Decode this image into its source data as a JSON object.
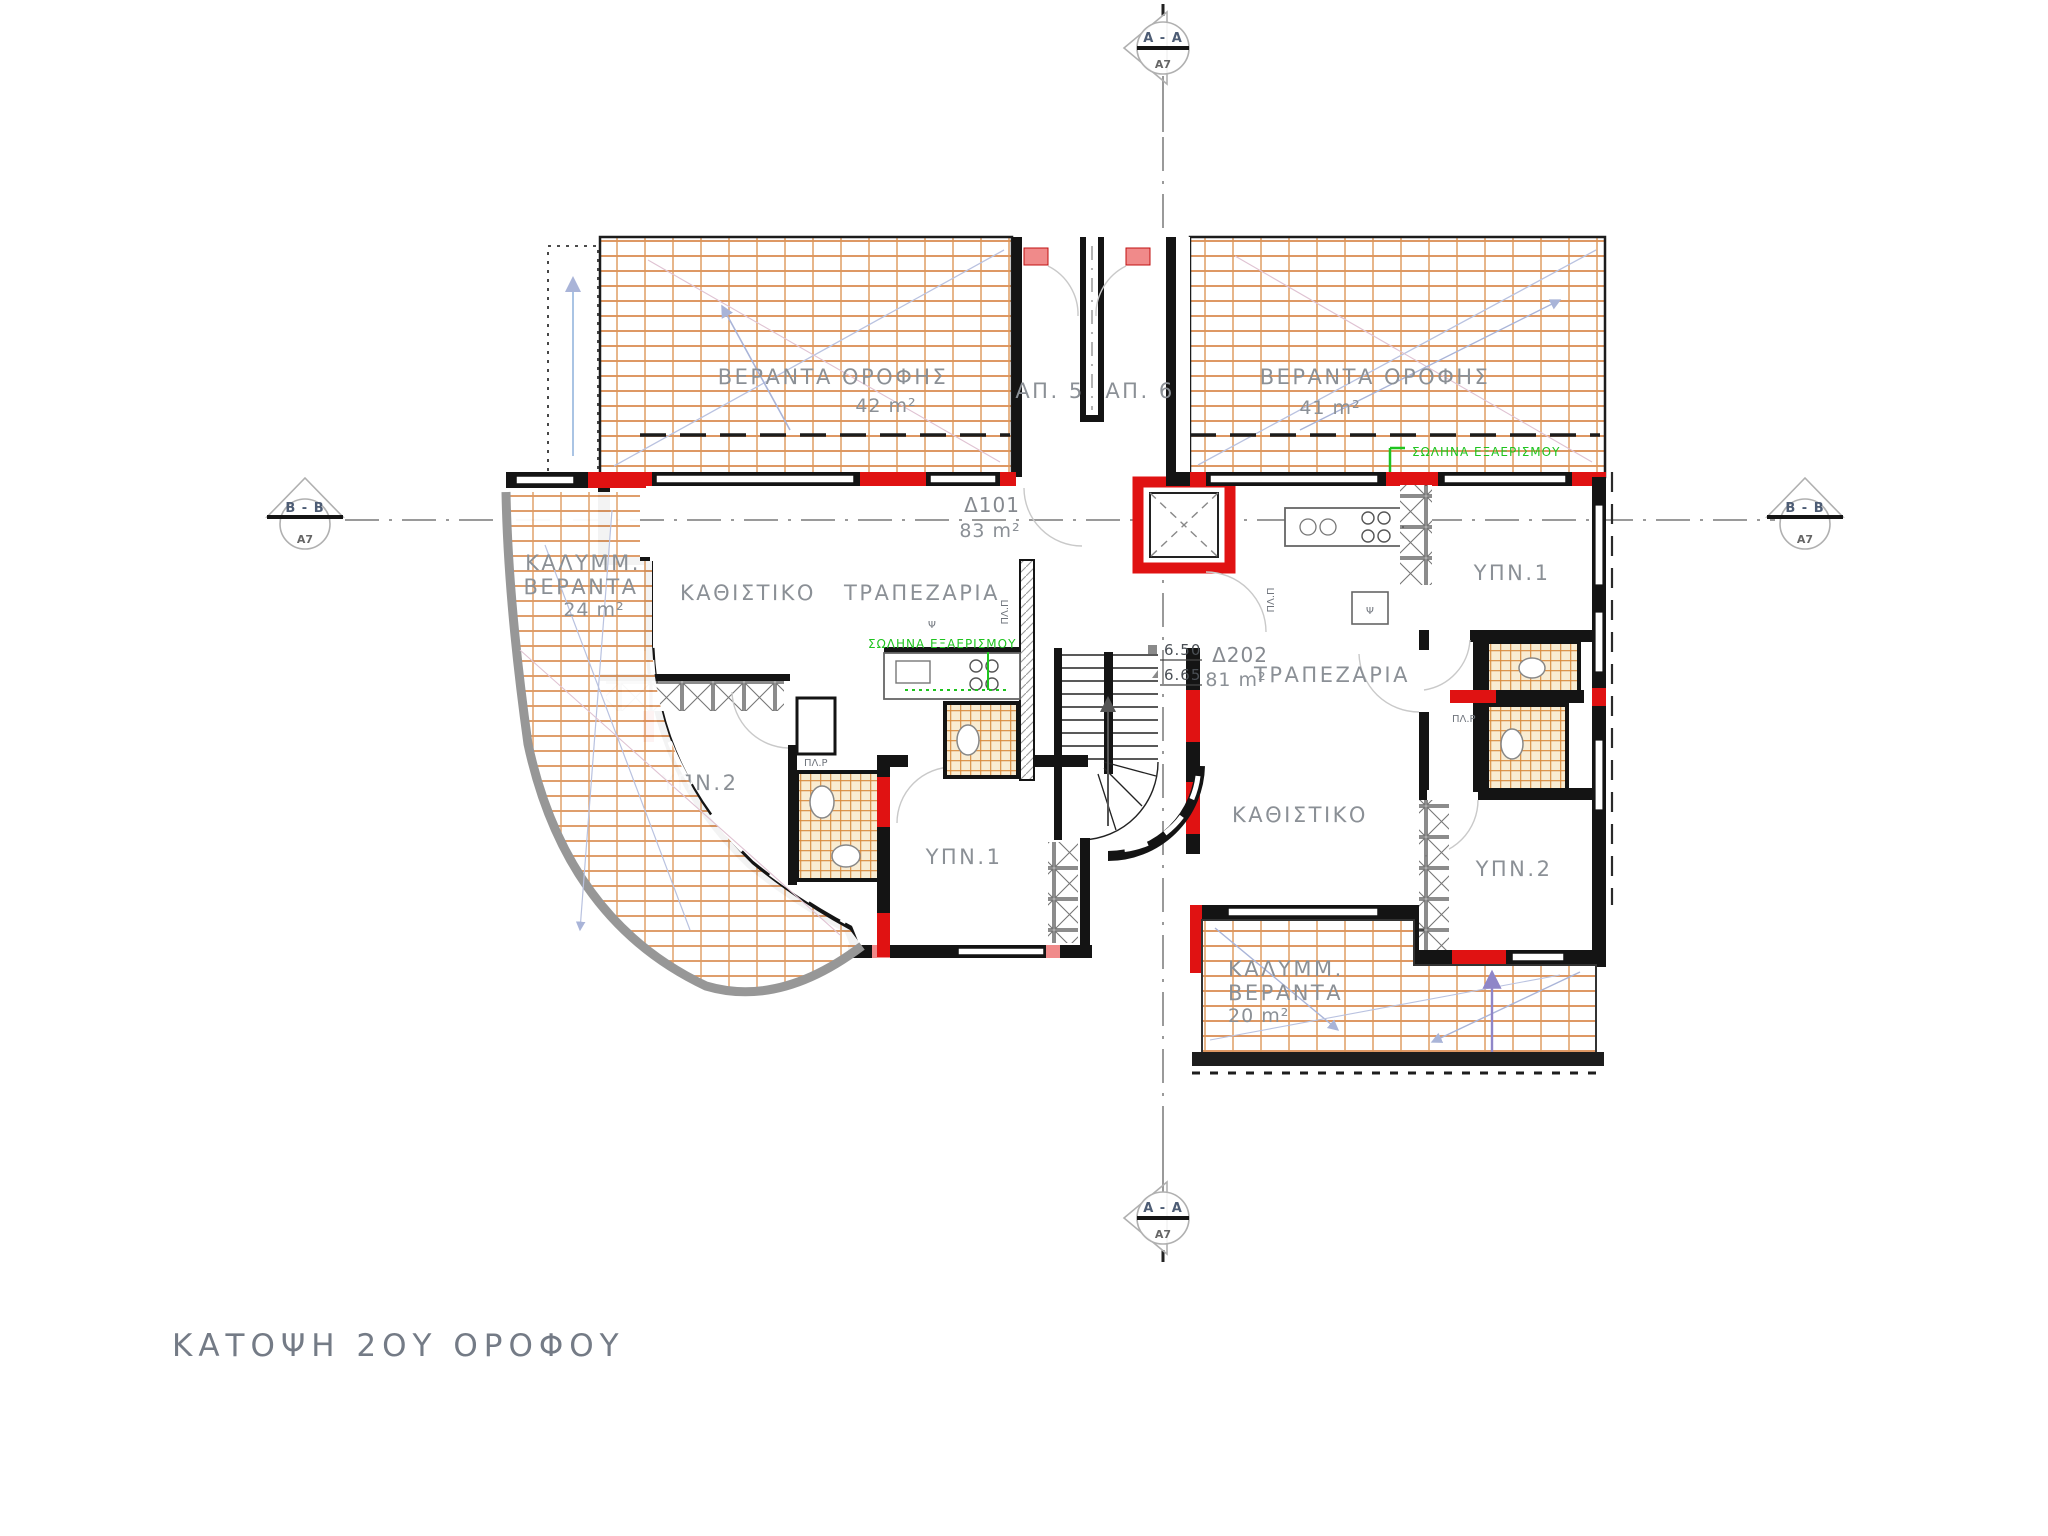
{
  "drawing_title": "ΚΑΤΟΨΗ 2ΟΥ ΟΡΟΦΟΥ",
  "sections": {
    "aa": "A - A",
    "bb": "B - B",
    "sheet": "A7"
  },
  "entrances": {
    "ap5": "ΑΠ. 5",
    "ap6": "ΑΠ. 6"
  },
  "levels": {
    "upper": "6.50",
    "lower": "6.65"
  },
  "apartment_d101": {
    "code": "Δ101",
    "area": "83 m²",
    "living": "ΚΑΘΙΣΤΙΚΟ",
    "dining": "ΤΡΑΠΕΖΑΡΙΑ",
    "bedroom1": "ΥΠΝ.1",
    "bedroom2": "ΥΠΝ.2"
  },
  "apartment_d202": {
    "code": "Δ202",
    "area": "81 m²",
    "living": "ΚΑΘΙΣΤΙΚΟ",
    "dining": "ΤΡΑΠΕΖΑΡΙΑ",
    "bedroom1": "ΥΠΝ.1",
    "bedroom2": "ΥΠΝ.2"
  },
  "verandas": {
    "roof_left": {
      "label": "ΒΕΡΑΝΤΑ ΟΡΟΦΗΣ",
      "area": "42 m²"
    },
    "roof_right": {
      "label": "ΒΕΡΑΝΤΑ ΟΡΟΦΗΣ",
      "area": "41 m²"
    },
    "covered_left": {
      "line1": "ΚΑΛΥΜΜ.",
      "line2": "ΒΕΡΑΝΤΑ",
      "area": "24 m²"
    },
    "covered_bottom": {
      "line1": "ΚΑΛΥΜΜ.",
      "line2": "ΒΕΡΑΝΤΑ",
      "area": "20 m²"
    }
  },
  "fixtures": {
    "vent_pipe": "ΣΩΛΗΝΑ ΕΞΑΕΡΙΣΜΟΥ",
    "washing_machine": "ΠΛ.Ρ",
    "dishwasher": "ΠΛ.Π",
    "fridge": "Ψ"
  },
  "colors": {
    "wall": "#141414",
    "highlight_red": "#e01212",
    "highlight_salmon": "#f08a8a",
    "tile_line": "#d8893c",
    "grid_line": "#d98a4e",
    "text_gray": "#8b9096",
    "vent_green": "#1ec41e",
    "section_gray": "#9a9a9a",
    "guide_lavender": "#a9b4d8"
  }
}
